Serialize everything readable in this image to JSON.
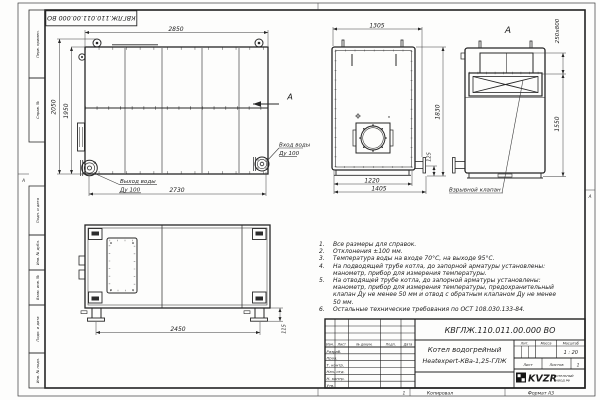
{
  "frame": {
    "stamp_rotated": "КВГЛЖ.110.011.00.000 ВО",
    "fields": [
      "Перв. примен.",
      "Справ. №",
      "Подп. и дата",
      "Инв. № дубл.",
      "Взам. инв. №",
      "Подп. и дата",
      "Инв. № подл."
    ],
    "zone_left": "А",
    "zone_right": "А",
    "zone_number": "1",
    "copied": "Копировал",
    "format": "Формат А3"
  },
  "views": {
    "side": {
      "dim_top": "2850",
      "dim_left_outer": "2050",
      "dim_left_inner": "1950",
      "dim_bottom": "2730",
      "outlet_line1": "Выход воды",
      "outlet_line2": "Ду 100",
      "inlet_line1": "Вход воды",
      "inlet_line2": "Ду 100",
      "arrow_label": "А"
    },
    "front": {
      "dim_top": "1305",
      "dim_right": "1830",
      "dim_stub": "125",
      "dim_bottom_inner": "1220",
      "dim_bottom_outer": "1405"
    },
    "rear": {
      "view_label": "А",
      "dim_valve": "250x800",
      "dim_height": "1550",
      "valve_callout": "Взрывной клапан"
    },
    "plan": {
      "dim_length": "2450",
      "dim_feet": "115"
    }
  },
  "notes": [
    {
      "n": "1.",
      "t": "Все размеры для справок."
    },
    {
      "n": "2.",
      "t": "Отклонения ±100 мм."
    },
    {
      "n": "3.",
      "t": "Температура воды на входе 70°С, на выходе 95°С."
    },
    {
      "n": "4.",
      "t": "На подводящей трубе котла, до запорной арматуры установлены: манометр, прибор для измерения температуры."
    },
    {
      "n": "5.",
      "t": "На отводящей трубе котла, до запорной арматуры установлены: манометр, прибор для измерения температуры, предохранительный клапан Ду не менее 50 мм и отвод с обратным клапаном Ду не менее 50 мм."
    },
    {
      "n": "6.",
      "t": "Остальные технические требования по ОСТ 108.030.133-84."
    }
  ],
  "title_block": {
    "doc_number": "КВГЛЖ.110.011.00.000 ВО",
    "product_line1": "Котел водогрейный",
    "product_line2": "Heatexpert-КВа-1,25-ГЛЖ",
    "scale_value": "1 : 20",
    "sheets_value": "1",
    "headers": {
      "lit": "Лит.",
      "mass": "Масса",
      "scale": "Масштаб",
      "sheet": "Лист",
      "sheets": "Листов"
    },
    "cols": {
      "izm": "Изм.",
      "list": "Лист",
      "doc": "№ докум.",
      "sign": "Подп.",
      "date": "Дата"
    },
    "rows": [
      "Разраб.",
      "Пров.",
      "Т. контр.",
      "Нач. отд.",
      "Н. контр.",
      "Утв."
    ],
    "logo": {
      "text": "KVZR",
      "caption1": "КОТЕЛЬНЫЙ",
      "caption2": "ЗАВОД РФ"
    }
  }
}
